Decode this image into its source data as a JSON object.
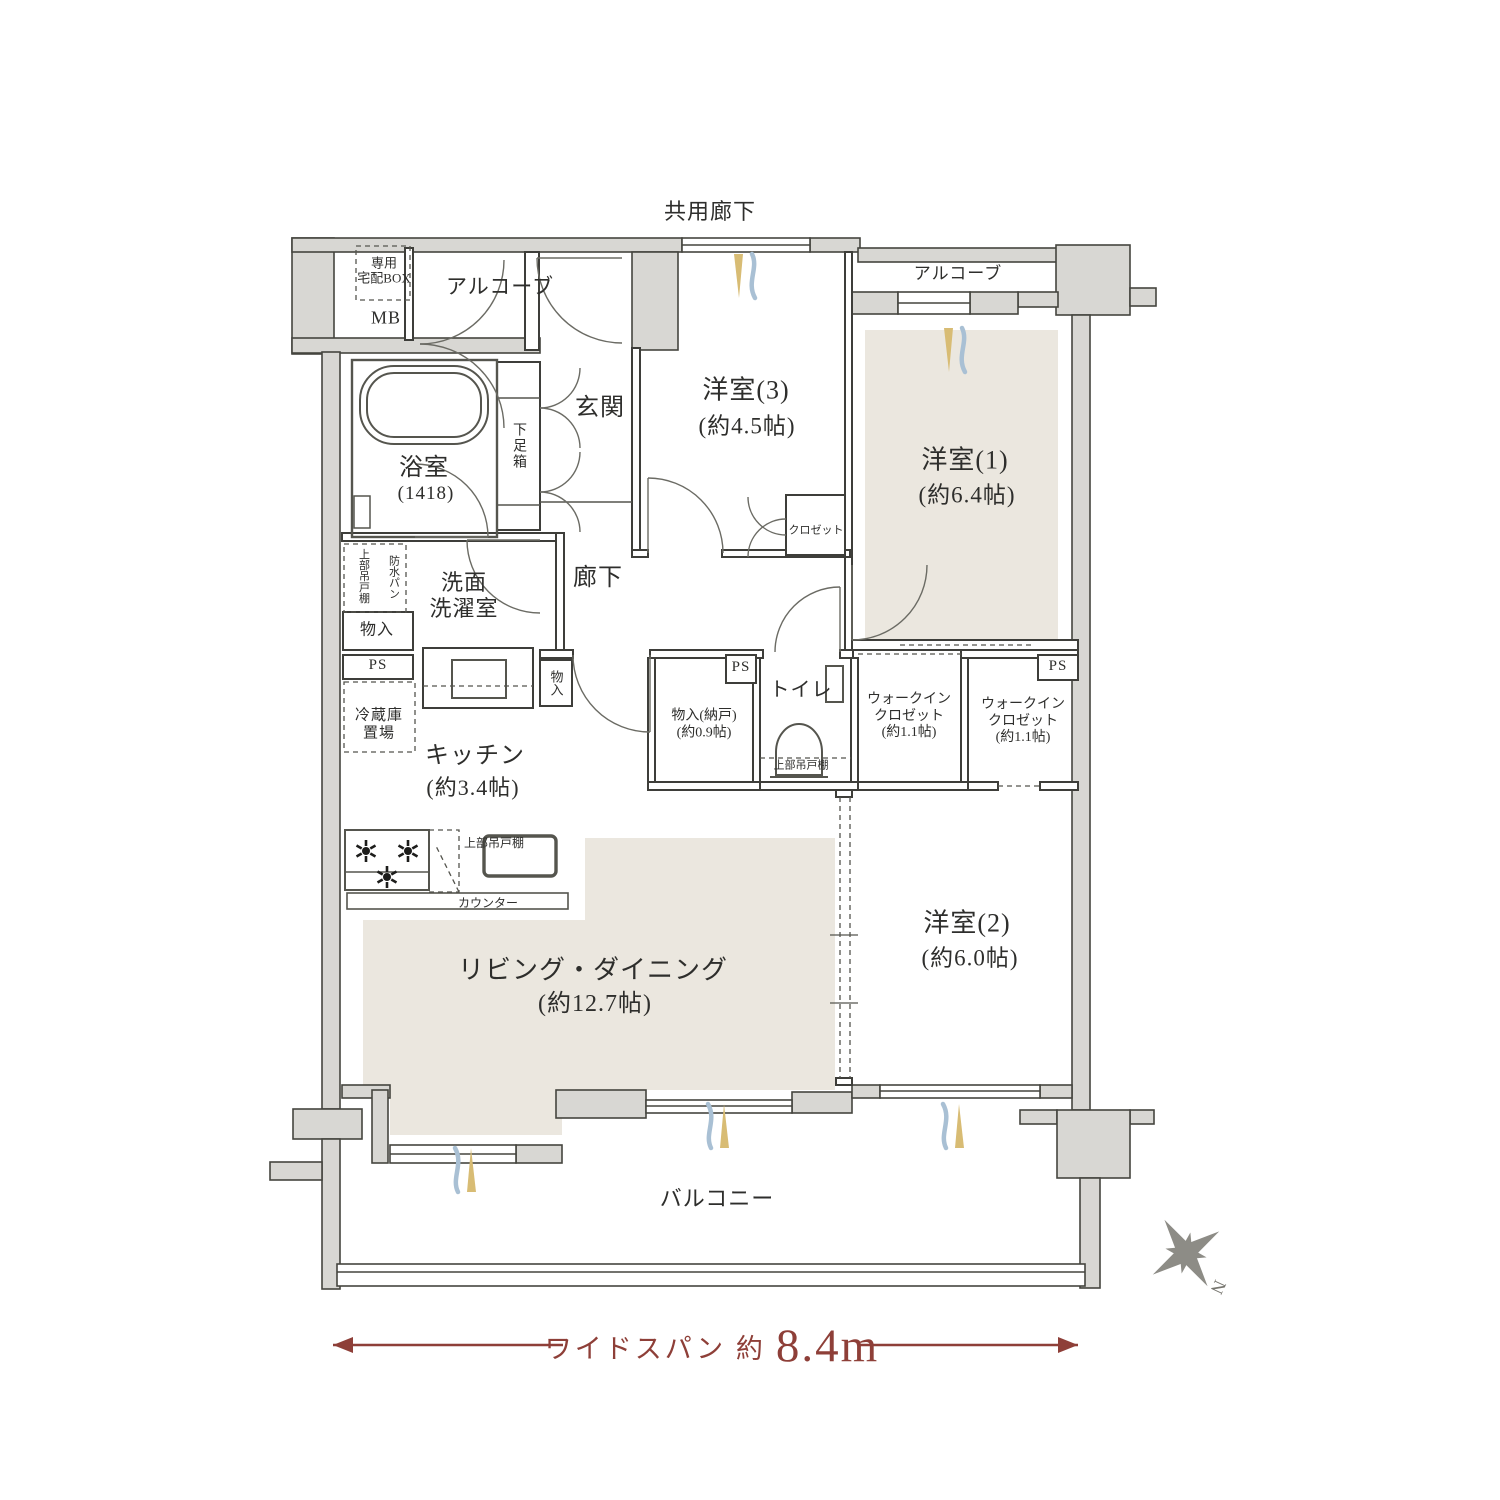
{
  "title": "マンション間取り図 3LDK ワイドスパン",
  "colors": {
    "accent_red": "#8e3f38",
    "floor_beige": "#ebe7df",
    "wall_gray": "#d8d7d3",
    "vent_yellow": "#d8bc74",
    "vent_blue": "#a9c0d4",
    "text": "#2e2e2c"
  },
  "labels": {
    "common_corridor": "共用廊下",
    "alcove_left": "アルコーブ",
    "alcove_right": "アルコーブ",
    "delivery_box": "専用\n宅配BOX",
    "meter_box": "MB",
    "room3_name": "洋室(3)",
    "room3_size": "(約4.5帖)",
    "room1_name": "洋室(1)",
    "room1_size": "(約6.4帖)",
    "bathroom_name": "浴室",
    "bathroom_size": "(1418)",
    "shoe_cabinet": "下足箱",
    "entrance": "玄関",
    "closet_room3": "クロゼット",
    "hallway": "廊下",
    "washroom": "洗面\n洗濯室",
    "upper_cabinet_laundry": "上部吊戸棚",
    "waterproof_pan": "防水パン",
    "storage_left": "物入",
    "ps_left": "PS",
    "fridge_space": "冷蔵庫\n置場",
    "kitchen_name": "キッチン",
    "kitchen_size": "(約3.4帖)",
    "storage_center": "物入",
    "storage_nando": "物入(納戸)\n(約0.9帖)",
    "ps_center": "PS",
    "toilet": "トイレ",
    "upper_cabinet_toilet": "上部吊戸棚",
    "wic_left": "ウォークイン\nクロゼット\n(約1.1帖)",
    "wic_right": "ウォークイン\nクロゼット\n(約1.1帖)",
    "ps_right": "PS",
    "upper_cabinet_kitchen": "上部吊戸棚",
    "counter": "カウンター",
    "living_name": "リビング・ダイニング",
    "living_size": "(約12.7帖)",
    "room2_name": "洋室(2)",
    "room2_size": "(約6.0帖)",
    "balcony": "バルコニー",
    "wide_span_prefix": "ワイドスパン 約",
    "wide_span_value": "8.4m",
    "compass_north": "N"
  }
}
